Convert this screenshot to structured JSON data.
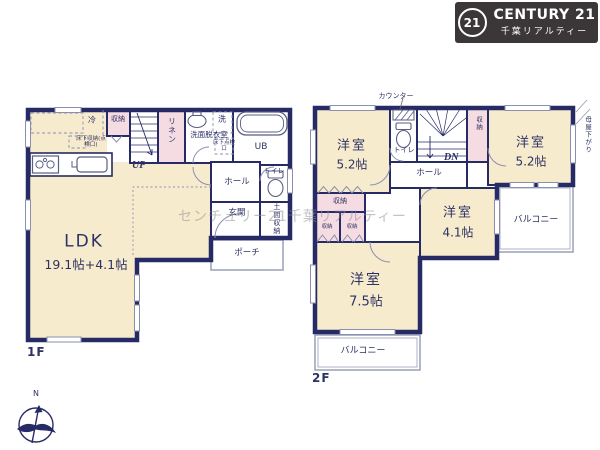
{
  "colors": {
    "wall": "#262b66",
    "room": "#f7ebcd",
    "closet": "#f5dce2",
    "logo_bg": "#3b3738"
  },
  "logo": {
    "badge": "21",
    "brand": "CENTURY 21",
    "subtitle": "千葉リアルティー"
  },
  "watermark": "センチュリー21千葉リアルティー",
  "compass": {
    "north": "N"
  },
  "floor1": {
    "label": "1F",
    "ldk_name": "LDK",
    "ldk_size": "19.1帖+4.1帖",
    "fridge": "冷",
    "closet": "収納",
    "underfloor_storage": "床下収納(点検口)",
    "stairs_up": "UP",
    "linen": "リネン",
    "washroom": "洗面脱衣室",
    "washer": "洗",
    "underfloor_hatch": "床下点検口",
    "bath": "UB",
    "hall": "ホール",
    "toilet": "トイレ",
    "entrance": "玄関",
    "entrance_storage": "土間収納",
    "porch": "ポーチ"
  },
  "floor2": {
    "label": "2F",
    "counter": "カウンター",
    "toilet": "トイレ",
    "stairs_down": "DN",
    "hall": "ホール",
    "closet_north": "収納",
    "closet_stair": "収納",
    "closet_a": "収納",
    "closet_b": "収納",
    "room_nw_name": "洋室",
    "room_nw_size": "5.2帖",
    "room_ne_name": "洋室",
    "room_ne_size": "5.2帖",
    "room_center_name": "洋室",
    "room_center_size": "4.1帖",
    "room_sw_name": "洋室",
    "room_sw_size": "7.5帖",
    "balcony_east": "バルコニー",
    "balcony_south": "バルコニー",
    "sloped_ceiling": "母屋下がり"
  }
}
